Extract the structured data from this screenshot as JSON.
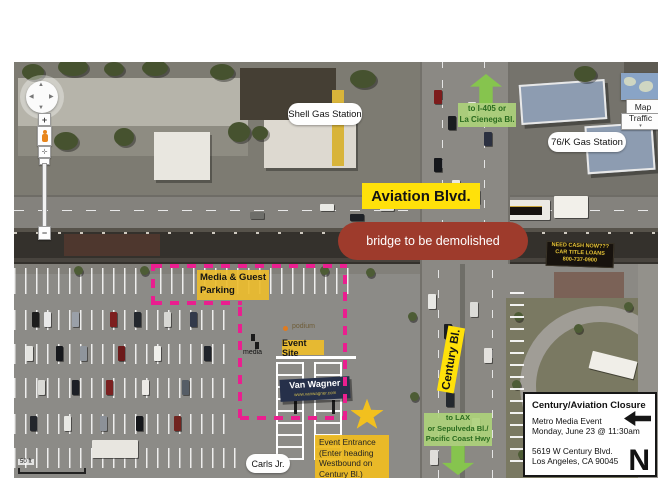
{
  "map_controls": {
    "pan_up": "▲",
    "pan_down": "▼",
    "pan_left": "◀",
    "pan_right": "▶",
    "zoom_in": "+",
    "zoom_out": "−",
    "map_button": "Map",
    "traffic_button": "Traffic",
    "traffic_caret": "▾",
    "scale_label": "50 ft"
  },
  "labels": {
    "shell_station": "Shell Gas Station",
    "gas_76k": "76/K Gas Station",
    "aviation_blvd": "Aviation Blvd.",
    "bridge": "bridge to be demolished",
    "media_parking_line1": "Media & Guest",
    "media_parking_line2": "Parking",
    "event_site": "Event Site",
    "podium": "podium",
    "media": "media",
    "century_bl": "Century Bl.",
    "carls_jr": "Carls Jr.",
    "event_entrance_lines": [
      "Event Entrance",
      "(Enter heading",
      "Westbound on",
      "Century Bl.)"
    ]
  },
  "direction_arrows": {
    "to_i405_lines": [
      "to I-405 or",
      "La Cienega Bl."
    ],
    "to_lax_lines": [
      "to LAX",
      "or Sepulveda Bl./",
      "Pacific Coast Hwy"
    ]
  },
  "info_box": {
    "title": "Century/Aviation Closure",
    "event_line1": "Metro Media Event",
    "event_line2": "Monday, June 23 @ 11:30am",
    "address_line1": "5619 W Century Blvd.",
    "address_line2": "Los Angeles, CA 90045",
    "north_label": "N"
  },
  "photo_text": {
    "billboard_name": "Van Wagner",
    "billboard_url": "www.vanwagner.com",
    "loans_sign_lines": [
      "NEED CASH NOW???",
      "CAR TITLE LOANS",
      "800-737-0900"
    ]
  },
  "colors": {
    "annotation_yellow": "#ffe10a",
    "annotation_amber": "#eabe2d",
    "bridge_red": "#9e3b2c",
    "dash_pink": "#ea1f8f",
    "arrow_green": "#86c44e",
    "arrow_text_green": "#2a6b1f",
    "star_gold": "#f2c01e"
  }
}
